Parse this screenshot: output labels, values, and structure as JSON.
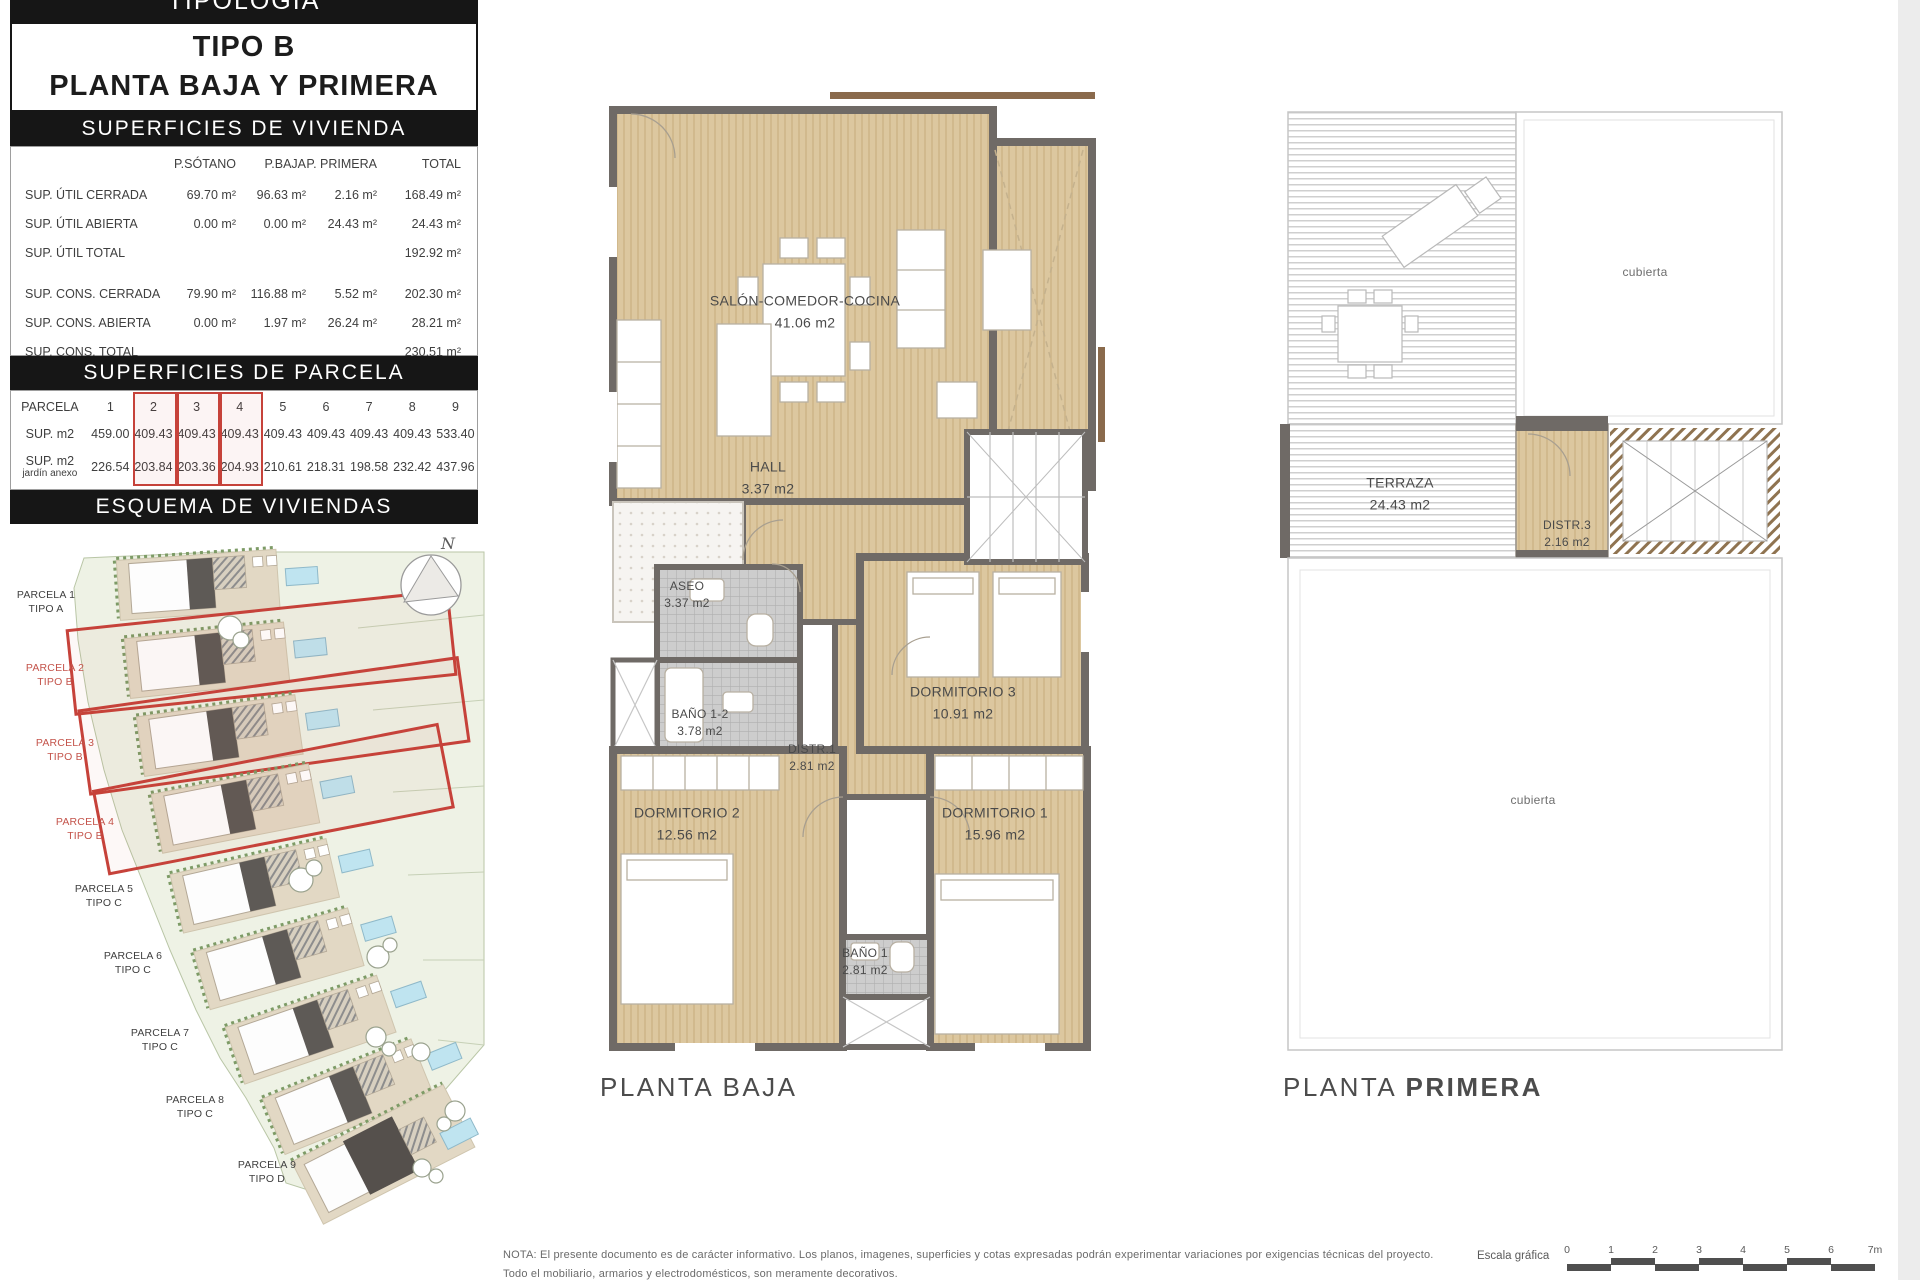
{
  "panel": {
    "top_bar": "TIPOLOGÍA",
    "tipo_title": "TIPO B",
    "tipo_subtitle": "PLANTA BAJA Y PRIMERA",
    "vivienda": {
      "title": "SUPERFICIES DE VIVIENDA",
      "col_headers": [
        "P.SÓTANO",
        "P.BAJA",
        "P. PRIMERA",
        "TOTAL"
      ],
      "rows": [
        {
          "label": "SUP. ÚTIL CERRADA",
          "v": [
            "69.70 m²",
            "96.63 m²",
            "2.16 m²",
            "168.49 m²"
          ]
        },
        {
          "label": "SUP. ÚTIL ABIERTA",
          "v": [
            "0.00 m²",
            "0.00 m²",
            "24.43 m²",
            "24.43 m²"
          ]
        },
        {
          "label": "SUP. ÚTIL TOTAL",
          "v": [
            "",
            "",
            "",
            "192.92 m²"
          ]
        },
        {
          "label": "SUP. CONS. CERRADA",
          "v": [
            "79.90 m²",
            "116.88 m²",
            "5.52 m²",
            "202.30 m²"
          ]
        },
        {
          "label": "SUP. CONS. ABIERTA",
          "v": [
            "0.00 m²",
            "1.97 m²",
            "26.24 m²",
            "28.21 m²"
          ]
        },
        {
          "label": "SUP. CONS. TOTAL",
          "v": [
            "",
            "",
            "",
            "230.51 m²"
          ]
        }
      ]
    },
    "parcela": {
      "title": "SUPERFICIES DE PARCELA",
      "row1_label": "PARCELA",
      "row2_label": "SUP. m2",
      "row3_label_line1": "SUP. m2",
      "row3_label_line2": "jardín anexo",
      "numbers": [
        "1",
        "2",
        "3",
        "4",
        "5",
        "6",
        "7",
        "8",
        "9"
      ],
      "sup": [
        "459.00",
        "409.43",
        "409.43",
        "409.43",
        "409.43",
        "409.43",
        "409.43",
        "409.43",
        "533.40"
      ],
      "jardin": [
        "226.54",
        "203.84",
        "203.36",
        "204.93",
        "210.61",
        "218.31",
        "198.58",
        "232.42",
        "437.96"
      ]
    },
    "esquema": {
      "title": "ESQUEMA DE VIVIENDAS",
      "north_label": "N",
      "parcels": [
        {
          "name": "PARCELA 1",
          "tipo": "TIPO A"
        },
        {
          "name": "PARCELA 2",
          "tipo": "TIPO B"
        },
        {
          "name": "PARCELA 3",
          "tipo": "TIPO B"
        },
        {
          "name": "PARCELA 4",
          "tipo": "TIPO B"
        },
        {
          "name": "PARCELA 5",
          "tipo": "TIPO C"
        },
        {
          "name": "PARCELA 6",
          "tipo": "TIPO C"
        },
        {
          "name": "PARCELA 7",
          "tipo": "TIPO C"
        },
        {
          "name": "PARCELA 8",
          "tipo": "TIPO C"
        },
        {
          "name": "PARCELA 9",
          "tipo": "TIPO D"
        }
      ]
    }
  },
  "planta_baja": {
    "caption": "PLANTA BAJA",
    "rooms": {
      "salon": {
        "name": "SALÓN-COMEDOR-COCINA",
        "area": "41.06 m2"
      },
      "hall": {
        "name": "HALL",
        "area": "3.37 m2"
      },
      "aseo": {
        "name": "ASEO",
        "area": "3.37 m2"
      },
      "bano12": {
        "name": "BAÑO 1-2",
        "area": "3.78 m2"
      },
      "distr1": {
        "name": "DISTR.1",
        "area": "2.81 m2"
      },
      "dorm3": {
        "name": "DORMITORIO 3",
        "area": "10.91 m2"
      },
      "dorm2": {
        "name": "DORMITORIO 2",
        "area": "12.56 m2"
      },
      "dorm1": {
        "name": "DORMITORIO 1",
        "area": "15.96 m2"
      },
      "bano1": {
        "name": "BAÑO 1",
        "area": "2.81 m2"
      }
    }
  },
  "planta_primera": {
    "caption_regular": "PLANTA",
    "caption_bold": "PRIMERA",
    "rooms": {
      "terraza": {
        "name": "TERRAZA",
        "area": "24.43 m2"
      },
      "distr3": {
        "name": "DISTR.3",
        "area": "2.16 m2"
      },
      "cubierta_top": "cubierta",
      "cubierta_bottom": "cubierta"
    }
  },
  "footer": {
    "nota_line1": "NOTA: El presente documento es de carácter informativo. Los planos, imagenes, superficies y cotas expresadas podrán experimentar variaciones por exigencias técnicas del proyecto.",
    "nota_line2": "Todo el mobiliario, armarios y electrodomésticos, son meramente decorativos.",
    "escala_label": "Escala gráfica",
    "escala_ticks": [
      "0",
      "1",
      "2",
      "3",
      "4",
      "5",
      "6",
      "7m"
    ]
  },
  "colors": {
    "accent_red": "#c6423a",
    "wall_gray": "#6f6a66",
    "floor_tan": "#dcc79f",
    "header_black": "#161616",
    "map_green": "#eef2e5",
    "pool_blue": "#bfe4f0"
  }
}
